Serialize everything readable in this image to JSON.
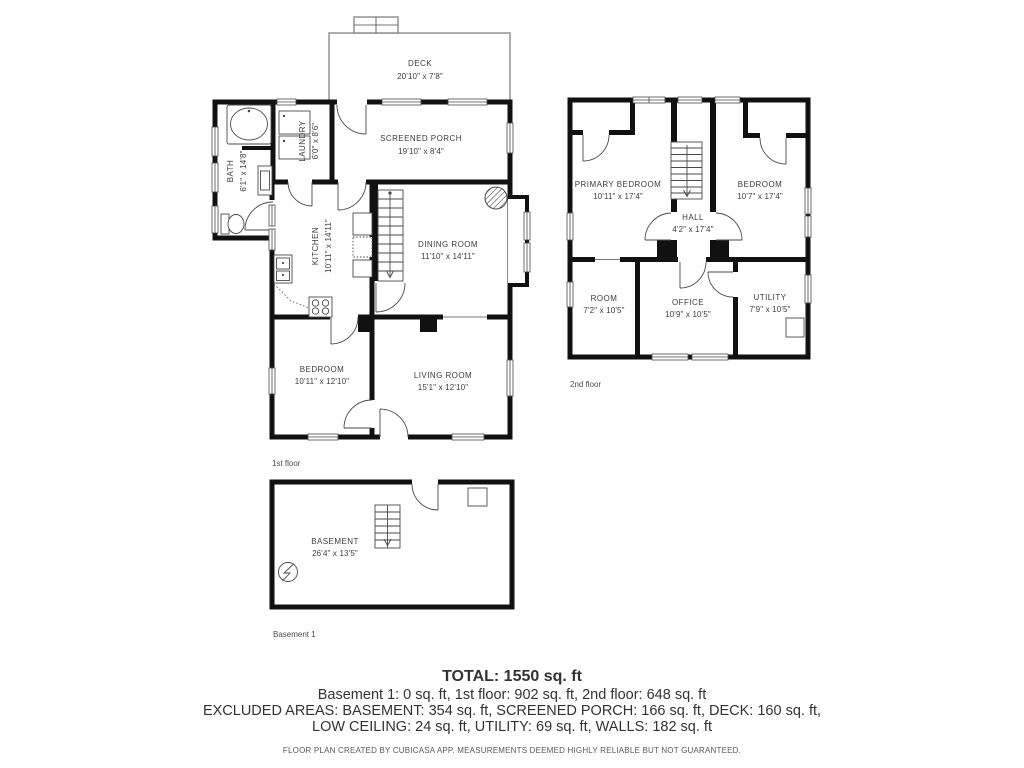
{
  "floors": {
    "first": {
      "label": "1st floor",
      "rooms": {
        "deck": {
          "name": "DECK",
          "dims": "20'10\" x 7'8\""
        },
        "screened_porch": {
          "name": "SCREENED PORCH",
          "dims": "19'10\" x 8'4\""
        },
        "laundry": {
          "name": "LAUNDRY",
          "dims": "6'0\" x 8'6\""
        },
        "bath": {
          "name": "BATH",
          "dims": "6'1\" x 14'8\""
        },
        "kitchen": {
          "name": "KITCHEN",
          "dims": "10'11\" x 14'11\""
        },
        "dining_room": {
          "name": "DINING ROOM",
          "dims": "11'10\" x 14'11\""
        },
        "bedroom": {
          "name": "BEDROOM",
          "dims": "10'11\" x 12'10\""
        },
        "living_room": {
          "name": "LIVING ROOM",
          "dims": "15'1\" x 12'10\""
        }
      }
    },
    "second": {
      "label": "2nd floor",
      "rooms": {
        "primary_bedroom": {
          "name": "PRIMARY BEDROOM",
          "dims": "10'11\" x 17'4\""
        },
        "bedroom": {
          "name": "BEDROOM",
          "dims": "10'7\" x 17'4\""
        },
        "hall": {
          "name": "HALL",
          "dims": "4'2\" x 17'4\""
        },
        "room": {
          "name": "ROOM",
          "dims": "7'2\" x 10'5\""
        },
        "office": {
          "name": "OFFICE",
          "dims": "10'9\" x 10'5\""
        },
        "utility": {
          "name": "UTILITY",
          "dims": "7'9\" x 10'5\""
        }
      }
    },
    "basement": {
      "label": "Basement 1",
      "rooms": {
        "basement": {
          "name": "BASEMENT",
          "dims": "26'4\" x 13'5\""
        }
      }
    }
  },
  "summary": {
    "total": "TOTAL: 1550 sq. ft",
    "floor_areas": "Basement 1: 0 sq. ft, 1st floor: 902 sq. ft, 2nd floor: 648 sq. ft",
    "excluded_line1": "EXCLUDED AREAS: BASEMENT: 354 sq. ft, SCREENED PORCH: 166 sq. ft, DECK: 160 sq. ft,",
    "excluded_line2": "LOW CEILING: 24 sq. ft, UTILITY: 69 sq. ft, WALLS: 182 sq. ft"
  },
  "footer": "FLOOR PLAN CREATED BY CUBICASA APP. MEASUREMENTS DEEMED HIGHLY RELIABLE BUT NOT GUARANTEED.",
  "colors": {
    "wall": "#111111",
    "annotation_text": "#3d3d3d",
    "thin_line": "#4a4a4a"
  }
}
